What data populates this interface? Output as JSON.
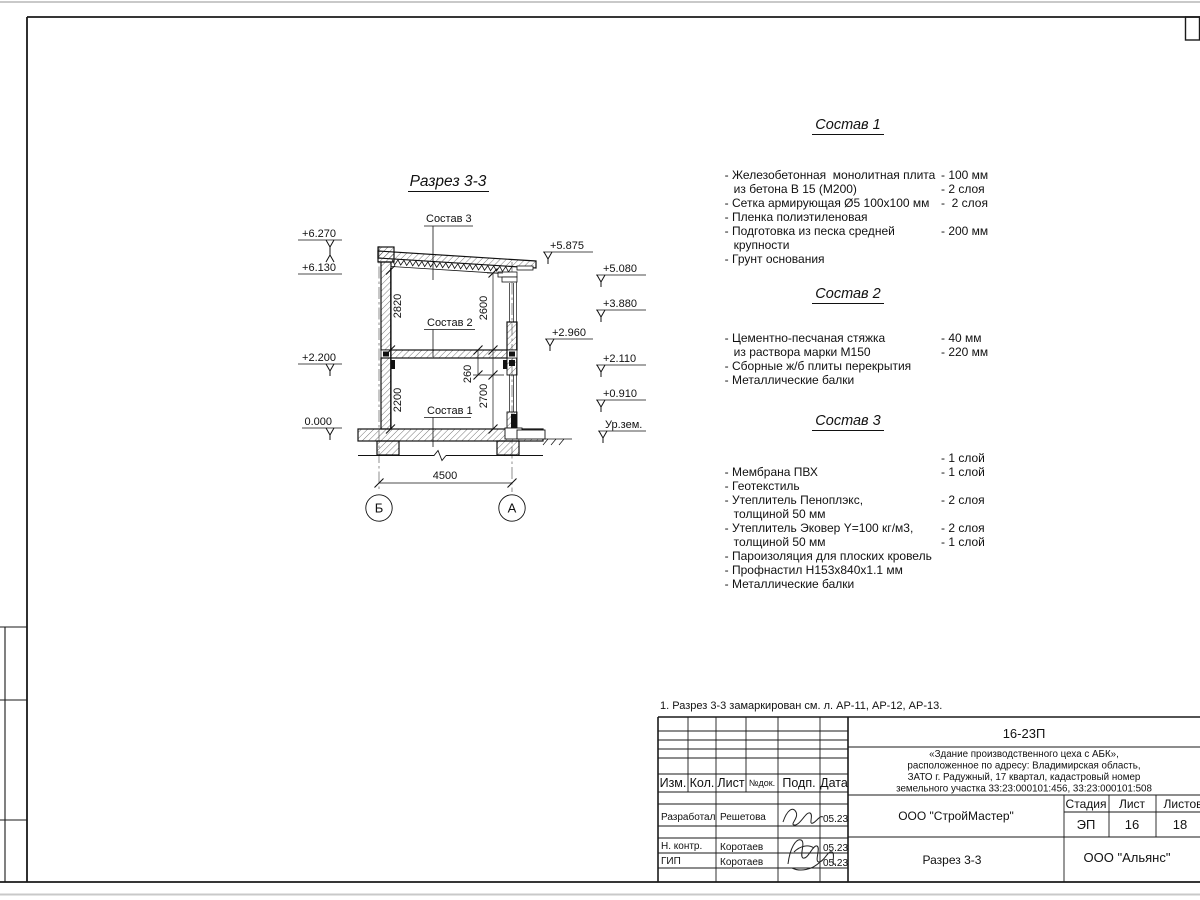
{
  "sheet": {
    "note": "1. Разрез 3-3 замаркирован см. л. АР-11, АР-12, АР-13."
  },
  "drawing": {
    "title": "Разрез 3-3",
    "layer_refs": {
      "roof": "Состав 3",
      "floor": "Состав 2",
      "ground": "Состав 1"
    },
    "elevations": {
      "left": [
        "+6.270",
        "+6.130",
        "+2.200",
        "0.000"
      ],
      "mid": [
        "+5.875",
        "+2.960"
      ],
      "right": [
        "+5.080",
        "+3.880",
        "+2.110",
        "+0.910",
        "Ур.зем."
      ]
    },
    "dims": {
      "h2_left": "2820",
      "h2_right": "2600",
      "slab": "260",
      "h1_right": "2700",
      "h1_left": "2200",
      "span": "4500"
    },
    "axes": {
      "left": "Б",
      "right": "А"
    }
  },
  "compositions": [
    {
      "title": "Состав 1",
      "rows": [
        {
          "t": "- Железобетонная  монолитная плита",
          "v": ""
        },
        {
          "t": "из бетона В 15 (М200)",
          "v": "- 100 мм",
          "indent": true
        },
        {
          "t": "- Сетка армирующая Ø5 100х100 мм",
          "v": "- 2 слоя"
        },
        {
          "t": "- Пленка полиэтиленовая",
          "v": "-  2 слоя"
        },
        {
          "t": "- Подготовка из песка средней",
          "v": ""
        },
        {
          "t": "крупности",
          "v": "- 200 мм",
          "indent": true
        },
        {
          "t": "- Грунт основания",
          "v": ""
        }
      ]
    },
    {
      "title": "Состав 2",
      "rows": [
        {
          "t": "- Цементно-песчаная стяжка",
          "v": ""
        },
        {
          "t": "из раствора марки М150",
          "v": "- 40 мм",
          "indent": true
        },
        {
          "t": "- Сборные ж/б плиты перекрытия",
          "v": "- 220 мм"
        },
        {
          "t": "- Металлические балки",
          "v": ""
        }
      ]
    },
    {
      "title": "Состав 3",
      "rows": [
        {
          "t": "- Мембрана ПВХ",
          "v": "- 1 слой"
        },
        {
          "t": "- Геотекстиль",
          "v": "- 1 слой"
        },
        {
          "t": "- Утеплитель Пеноплэкс,",
          "v": ""
        },
        {
          "t": "толщиной 50 мм",
          "v": "- 2 слоя",
          "indent": true
        },
        {
          "t": "- Утеплитель Эковер Y=100 кг/м3,",
          "v": ""
        },
        {
          "t": "толщиной 50 мм",
          "v": "- 2 слоя",
          "indent": true
        },
        {
          "t": "- Пароизоляция для плоских кровель",
          "v": "- 1 слой"
        },
        {
          "t": "- Профнастил Н153х840х1.1 мм",
          "v": ""
        },
        {
          "t": "- Металлические балки",
          "v": ""
        }
      ]
    }
  ],
  "titleblock": {
    "doc_number": "16-23П",
    "description_lines": [
      "«Здание производственного цеха с АБК»,",
      "расположенное по адресу: Владимирская область,",
      "ЗАТО г. Радужный, 17 квартал, кадастровый номер",
      "земельного участка 33:23:000101:456, 33:23:000101:508"
    ],
    "columns": {
      "izm": "Изм.",
      "kol": "Кол.",
      "list": "Лист",
      "ndok": "№док.",
      "podp": "Подп.",
      "data": "Дата"
    },
    "signers": [
      {
        "role": "Разработал",
        "name": "Решетова",
        "date": "05.23"
      },
      {
        "role": "Н. контр.",
        "name": "Коротаев",
        "date": "05.23"
      },
      {
        "role": "ГИП",
        "name": "Коротаев",
        "date": "05.23"
      }
    ],
    "contractor": "ООО \"СтройМастер\"",
    "stage_label": "Стадия",
    "sheet_label": "Лист",
    "sheets_label": "Листов",
    "stage": "ЭП",
    "sheet_no": "16",
    "sheets_total": "18",
    "sheet_title": "Разрез 3-3",
    "customer": "ООО \"Альянс\""
  }
}
